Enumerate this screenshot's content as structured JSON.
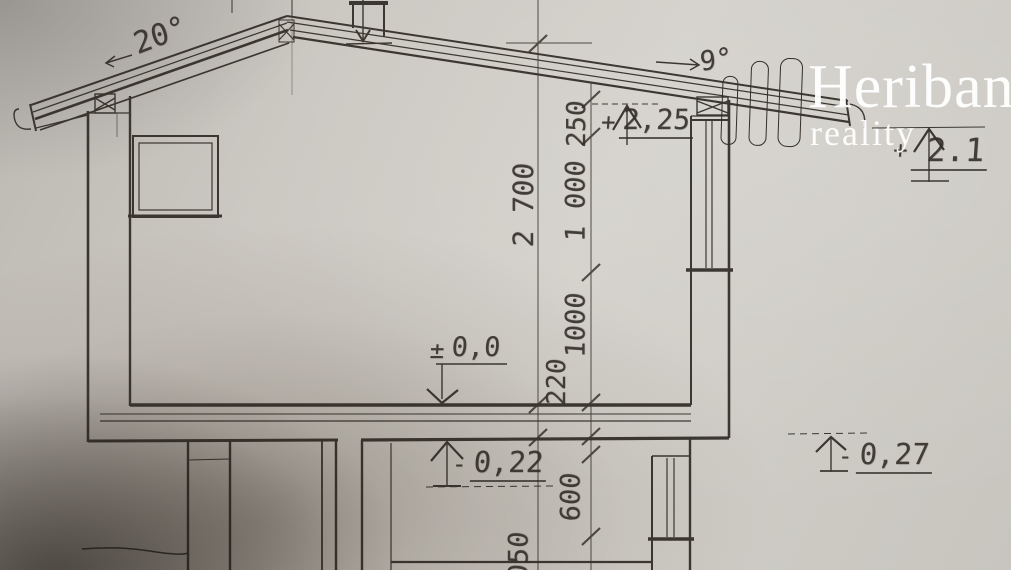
{
  "watermark": {
    "brand": "Heriban",
    "subtitle": "reality"
  },
  "roof": {
    "left_slope_angle": "20°",
    "right_slope_angle": "9°"
  },
  "levels": {
    "attic_ceiling": {
      "sign": "+",
      "value": "2,25"
    },
    "roof_eave": {
      "sign": "+",
      "value": "2.1"
    },
    "ground_floor": {
      "sign": "±",
      "value": "0,0"
    },
    "basement_ceiling": {
      "sign": "-",
      "value": "0,22"
    },
    "terrain": {
      "sign": "-",
      "value": "0,27"
    }
  },
  "dimensions": {
    "room_height": "2 700",
    "roof_offset": "250",
    "upper_wall": "1 000",
    "lower_wall": "1000",
    "floor_slab": "220",
    "basement_window": "600",
    "basement_partial": "050"
  },
  "colors": {
    "ink": "#332f28",
    "paper": "#cfccc6",
    "watermark": "#ffffff"
  }
}
